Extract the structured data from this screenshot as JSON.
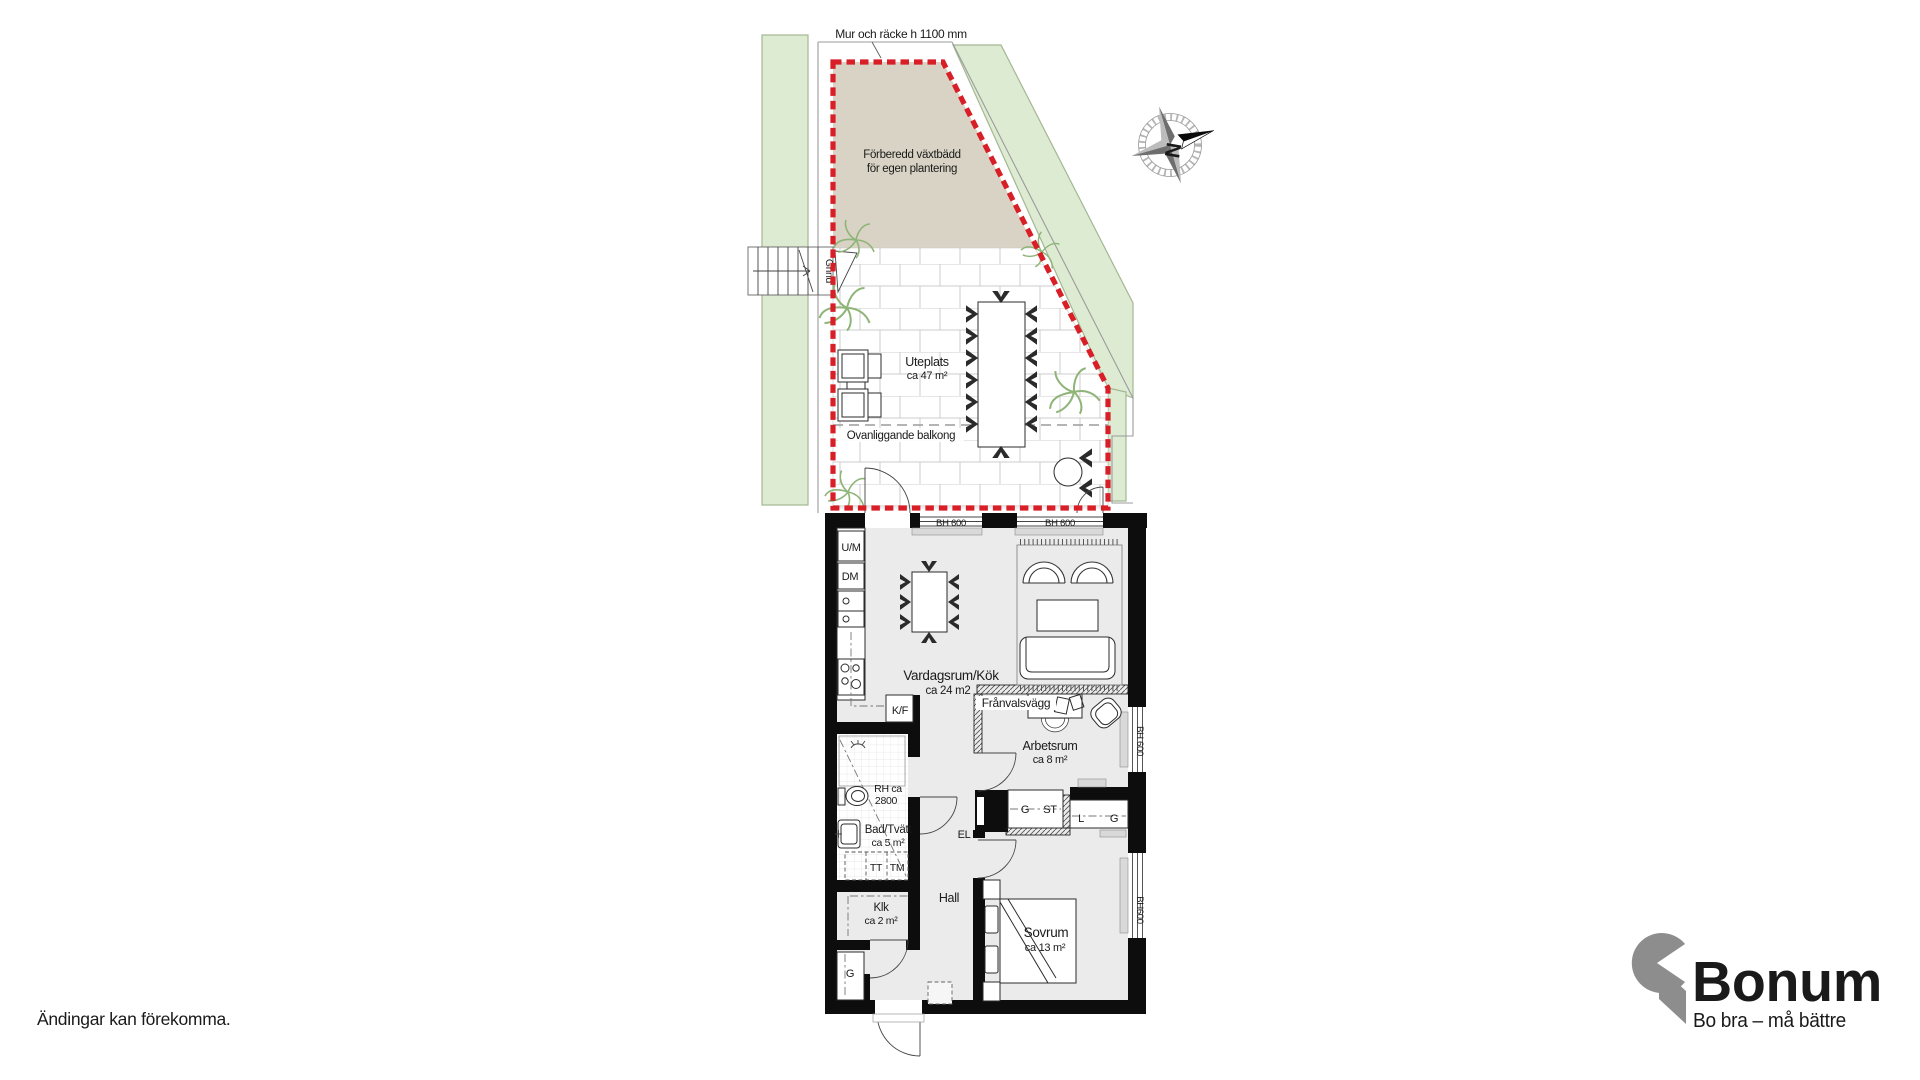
{
  "site": {
    "wall_note": "Mur och räcke h 1100 mm",
    "gate": "Grind",
    "plantbed": {
      "line1": "Förberedd  växtbädd",
      "line2": "för egen plantering"
    },
    "terrace": {
      "name": "Uteplats",
      "area": "ca 47 m²"
    },
    "balcony_note": "Ovanliggande balkong"
  },
  "compass": {
    "north": "N"
  },
  "plan": {
    "living": {
      "name": "Vardagsrum/Kök",
      "area": "ca 24 m2"
    },
    "office": {
      "name": "Arbetsrum",
      "area": "ca 8 m²"
    },
    "bedroom": {
      "name": "Sovrum",
      "area": "ca 13 m²"
    },
    "bath": {
      "name": "Bad/Tvätt",
      "area": "ca 5 m²"
    },
    "klk": {
      "name": "Klk",
      "area": "ca 2 m²"
    },
    "hall": {
      "name": "Hall"
    },
    "franvalsvagg": "Frånvalsvägg",
    "labels": {
      "um": "U/M",
      "dm": "DM",
      "kf": "K/F",
      "tt": "TT",
      "tm": "TM",
      "el": "EL",
      "g_st": {
        "g": "G",
        "st": "ST"
      },
      "l_g": {
        "l": "L",
        "g": "G"
      },
      "g_entry": "G",
      "rh": {
        "line1": "RH ca",
        "line2": "2800"
      },
      "bh_top_left": "BH 600",
      "bh_top_right": "BH 600",
      "bh_right_office": "BH 600",
      "bh_right_bedroom": "BH600"
    }
  },
  "footer": {
    "disclaimer": "Ändingar kan förekomma."
  },
  "brand": {
    "name": "Bonum",
    "tagline": "Bo bra – må bättre",
    "orange": "#F59C1E",
    "gray": "#8D8D8D"
  },
  "colors": {
    "boundary_red": "#D81E26",
    "hedge_green": "#DCEBD2",
    "hedge_edge": "#A3B793",
    "plantbed_beige": "#D8D3C4",
    "floor_gray": "#EBEBEB"
  }
}
